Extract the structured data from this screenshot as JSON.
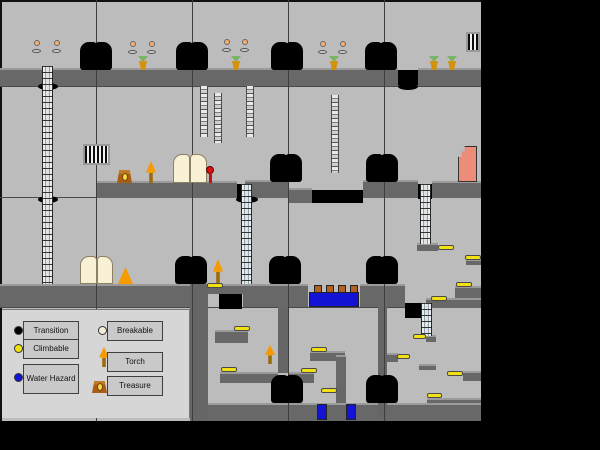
{
  "meta": {
    "description": "Platformer level map with legend",
    "map": {
      "width": 481,
      "height": 421,
      "columns": 5,
      "rows": 4,
      "room_width": 96
    }
  },
  "palette": {
    "background": "#000000",
    "room": "#bcbcbc",
    "platform": "#686868",
    "platform_edge": "#9b9b9b",
    "transition": "#000000",
    "climbable": "#f2e112",
    "water_hazard": "#1313d6",
    "breakable": "#f5eed6",
    "torch_flame": "#f59a00",
    "treasure": "#b3641e",
    "large_vase": "#ec8d7a",
    "legend_panel": "#d6d6d6"
  },
  "legend": {
    "items": [
      {
        "id": "transition",
        "label": "Transition",
        "swatch": "circle",
        "color": "#000000"
      },
      {
        "id": "climbable",
        "label": "Climbable",
        "swatch": "circle",
        "color": "#f2e112"
      },
      {
        "id": "water_hazard",
        "label": "Water Hazard",
        "swatch": "circle",
        "color": "#1313d6"
      },
      {
        "id": "breakable",
        "label": "Breakable",
        "swatch": "circle",
        "color": "#f5eed6"
      },
      {
        "id": "torch",
        "label": "Torch",
        "swatch": "torch-icon",
        "color": "#f59a00"
      },
      {
        "id": "treasure",
        "label": "Treasure",
        "swatch": "chest-icon",
        "color": "#b3641e"
      }
    ]
  },
  "map_layers": [
    {
      "type": "hline",
      "items": [
        [
          0,
          86,
          481,
          1
        ],
        [
          0,
          197,
          481,
          1
        ],
        [
          0,
          307,
          481,
          1
        ]
      ]
    },
    {
      "type": "plat",
      "items": [
        [
          0,
          68,
          398,
          18
        ],
        [
          418,
          68,
          63,
          18
        ],
        [
          97,
          181,
          140,
          17
        ],
        [
          245,
          180,
          43,
          18
        ],
        [
          288,
          188,
          24,
          15
        ],
        [
          363,
          180,
          55,
          18
        ],
        [
          432,
          181,
          49,
          17
        ],
        [
          0,
          284,
          190,
          23
        ],
        [
          190,
          284,
          53,
          10
        ],
        [
          243,
          284,
          65,
          23
        ],
        [
          360,
          284,
          45,
          23
        ],
        [
          417,
          243,
          21,
          8
        ],
        [
          466,
          259,
          15,
          6
        ],
        [
          426,
          298,
          55,
          10
        ],
        [
          455,
          286,
          26,
          12
        ],
        [
          215,
          330,
          33,
          13
        ],
        [
          220,
          372,
          58,
          11
        ],
        [
          310,
          351,
          35,
          10
        ],
        [
          288,
          372,
          26,
          11
        ],
        [
          336,
          355,
          10,
          50
        ],
        [
          387,
          353,
          11,
          9
        ],
        [
          419,
          364,
          17,
          6
        ],
        [
          426,
          335,
          10,
          7
        ],
        [
          463,
          371,
          18,
          10
        ],
        [
          427,
          398,
          54,
          23
        ],
        [
          205,
          403,
          276,
          18
        ]
      ]
    },
    {
      "type": "wall",
      "items": [
        [
          190,
          284,
          18,
          137
        ],
        [
          278,
          307,
          10,
          66
        ],
        [
          378,
          307,
          9,
          114
        ]
      ]
    },
    {
      "type": "vline",
      "items": [
        [
          96,
          0,
          1,
          421
        ],
        [
          192,
          0,
          1,
          421
        ],
        [
          288,
          0,
          1,
          421
        ],
        [
          384,
          0,
          1,
          421
        ]
      ]
    },
    {
      "type": "pit",
      "items": [
        [
          398,
          70,
          20,
          15
        ],
        [
          237,
          184,
          15,
          14
        ],
        [
          418,
          184,
          14,
          15
        ],
        [
          312,
          190,
          51,
          13
        ],
        [
          219,
          294,
          23,
          15
        ],
        [
          405,
          303,
          18,
          15
        ]
      ]
    },
    {
      "type": "hole",
      "items": [
        [
          38,
          83,
          20,
          7
        ],
        [
          38,
          196,
          20,
          7
        ],
        [
          398,
          83,
          20,
          7
        ],
        [
          236,
          196,
          22,
          7
        ]
      ]
    },
    {
      "type": "water",
      "items": [
        [
          309,
          292,
          50,
          15
        ],
        [
          317,
          404,
          10,
          16
        ],
        [
          346,
          404,
          10,
          16
        ]
      ]
    },
    {
      "type": "post",
      "items": [
        [
          314,
          285,
          8,
          8
        ],
        [
          326,
          285,
          8,
          8
        ],
        [
          338,
          285,
          8,
          8
        ],
        [
          350,
          285,
          8,
          8
        ]
      ]
    },
    {
      "type": "ladder",
      "items": [
        [
          42,
          66,
          11,
          218
        ],
        [
          241,
          184,
          11,
          100
        ],
        [
          420,
          184,
          11,
          60
        ],
        [
          421,
          303,
          11,
          33
        ]
      ]
    },
    {
      "type": "chain",
      "items": [
        [
          200,
          86,
          8,
          51
        ],
        [
          214,
          93,
          8,
          50
        ],
        [
          246,
          86,
          8,
          51
        ],
        [
          331,
          95,
          8,
          78
        ]
      ]
    },
    {
      "type": "grate",
      "items": [
        [
          83,
          144,
          27,
          21
        ],
        [
          466,
          32,
          14,
          20
        ]
      ]
    },
    {
      "type": "book",
      "items": [
        [
          173,
          154,
          34,
          29
        ],
        [
          80,
          256,
          33,
          28
        ]
      ]
    },
    {
      "type": "chest",
      "items": [
        [
          117,
          170,
          15,
          13
        ]
      ]
    },
    {
      "type": "torch",
      "items": [
        [
          146,
          161,
          10,
          22
        ],
        [
          213,
          259,
          10,
          24
        ],
        [
          265,
          345,
          10,
          19
        ]
      ]
    },
    {
      "type": "cone",
      "items": [
        [
          118,
          267,
          15,
          17
        ]
      ]
    },
    {
      "type": "candle",
      "items": [
        [
          32,
          40,
          10,
          13
        ],
        [
          52,
          40,
          10,
          13
        ],
        [
          128,
          41,
          10,
          13
        ],
        [
          147,
          41,
          10,
          13
        ],
        [
          222,
          39,
          10,
          13
        ],
        [
          240,
          39,
          10,
          13
        ],
        [
          318,
          41,
          10,
          13
        ],
        [
          338,
          41,
          10,
          13
        ]
      ]
    },
    {
      "type": "vase",
      "items": [
        [
          138,
          56,
          10,
          14
        ],
        [
          231,
          56,
          10,
          14
        ],
        [
          329,
          56,
          10,
          14
        ],
        [
          429,
          56,
          10,
          14
        ],
        [
          447,
          56,
          10,
          14
        ]
      ]
    },
    {
      "type": "lever",
      "items": [
        [
          206,
          166,
          8,
          17
        ]
      ]
    },
    {
      "type": "svase",
      "items": [
        [
          458,
          146,
          19,
          36
        ]
      ]
    },
    {
      "type": "ybar",
      "items": [
        [
          207,
          283,
          16,
          5
        ],
        [
          438,
          245,
          16,
          5
        ],
        [
          465,
          255,
          16,
          5
        ],
        [
          456,
          282,
          16,
          5
        ],
        [
          431,
          296,
          16,
          5
        ],
        [
          234,
          326,
          16,
          5
        ],
        [
          221,
          367,
          16,
          5
        ],
        [
          311,
          347,
          16,
          5
        ],
        [
          301,
          368,
          16,
          5
        ],
        [
          321,
          388,
          16,
          5
        ],
        [
          413,
          334,
          13,
          5
        ],
        [
          397,
          354,
          13,
          5
        ],
        [
          447,
          371,
          16,
          5
        ],
        [
          427,
          393,
          15,
          5
        ]
      ]
    },
    {
      "type": "blob",
      "items": [
        [
          80,
          42,
          32,
          28
        ],
        [
          176,
          42,
          32,
          28
        ],
        [
          271,
          42,
          32,
          28
        ],
        [
          365,
          42,
          32,
          28
        ],
        [
          270,
          154,
          32,
          28
        ],
        [
          366,
          154,
          32,
          28
        ],
        [
          175,
          256,
          32,
          28
        ],
        [
          269,
          256,
          32,
          28
        ],
        [
          366,
          256,
          32,
          28
        ],
        [
          271,
          375,
          32,
          28
        ],
        [
          366,
          375,
          32,
          28
        ]
      ]
    }
  ]
}
